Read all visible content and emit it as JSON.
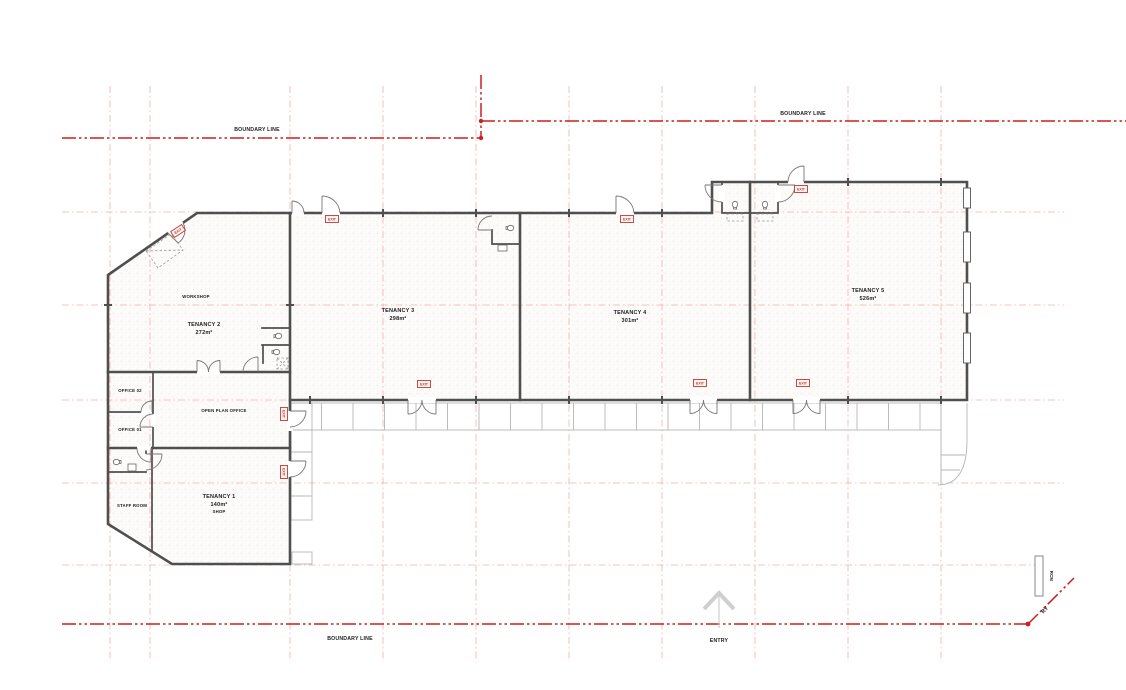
{
  "meta": {
    "width": 1126,
    "height": 690,
    "drawing_type": "architectural floor plan"
  },
  "colors": {
    "boundary_red": "#cc1f1f",
    "grid_pink": "#f0b2ae",
    "wall_gray": "#4f4f4f",
    "detail_gray": "#777777",
    "canopy_gray": "#b5b5b5",
    "exit_red": "#c03a30",
    "label_black": "#1c1c1c",
    "floor_white": "#fcfbf9",
    "arrow_gray": "#cfcfcf"
  },
  "boundary": {
    "top_left_label": "BOUNDARY LINE",
    "top_right_label": "BOUNDARY LINE",
    "bottom_label": "BOUNDARY LINE"
  },
  "entry": {
    "label": "ENTRY"
  },
  "exit_sign": {
    "label": "EXIT"
  },
  "markers": {
    "rcm_label": "RCM",
    "boundary_diagonal_label": "RY"
  },
  "rooms": {
    "tenancy1": {
      "name": "TENANCY 1",
      "area": "140m²",
      "type": "SHOP"
    },
    "tenancy2": {
      "name": "TENANCY 2",
      "area": "272m²"
    },
    "tenancy3": {
      "name": "TENANCY 3",
      "area": "298m²"
    },
    "tenancy4": {
      "name": "TENANCY 4",
      "area": "301m²"
    },
    "tenancy5": {
      "name": "TENANCY 5",
      "area": "526m²"
    },
    "workshop": {
      "name": "WORKSHOP"
    },
    "open_plan_office": {
      "name": "OPEN PLAN OFFICE"
    },
    "office01": {
      "name": "OFFICE 01"
    },
    "office02": {
      "name": "OFFICE 02"
    },
    "staff_room": {
      "name": "STAFF ROOM"
    }
  }
}
